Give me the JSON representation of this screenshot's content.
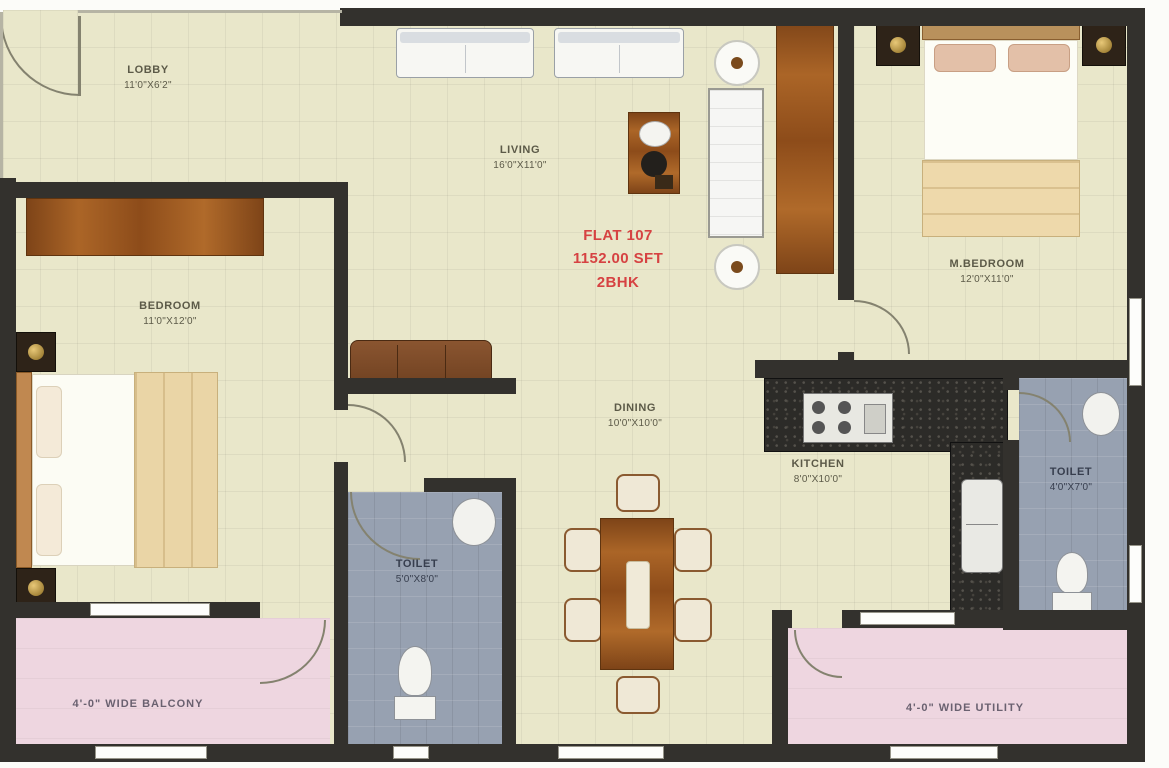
{
  "flat": {
    "line1": "FLAT 107",
    "line2": "1152.00 SFT",
    "line3": "2BHK"
  },
  "rooms": {
    "lobby": {
      "name": "LOBBY",
      "dims": "11'0\"X6'2\""
    },
    "living": {
      "name": "LIVING",
      "dims": "16'0\"X11'0\""
    },
    "bedroom": {
      "name": "BEDROOM",
      "dims": "11'0\"X12'0\""
    },
    "master_bedroom": {
      "name": "M.BEDROOM",
      "dims": "12'0\"X11'0\""
    },
    "dining": {
      "name": "DINING",
      "dims": "10'0\"X10'0\""
    },
    "kitchen": {
      "name": "KITCHEN",
      "dims": "8'0\"X10'0\""
    },
    "toilet_center": {
      "name": "TOILET",
      "dims": "5'0\"X8'0\""
    },
    "toilet_right": {
      "name": "TOILET",
      "dims": "4'0\"X7'0\""
    },
    "balcony": {
      "name": "4'-0\" WIDE BALCONY"
    },
    "utility": {
      "name": "4'-0\" WIDE UTILITY"
    }
  },
  "colors": {
    "wall": "#33312d",
    "floor_tile": "#e9e7ca",
    "toilet_floor": "#97a1b1",
    "balcony_floor": "#eed6e0",
    "wood": "#a2601f",
    "flat_text_red": "#d64242"
  }
}
